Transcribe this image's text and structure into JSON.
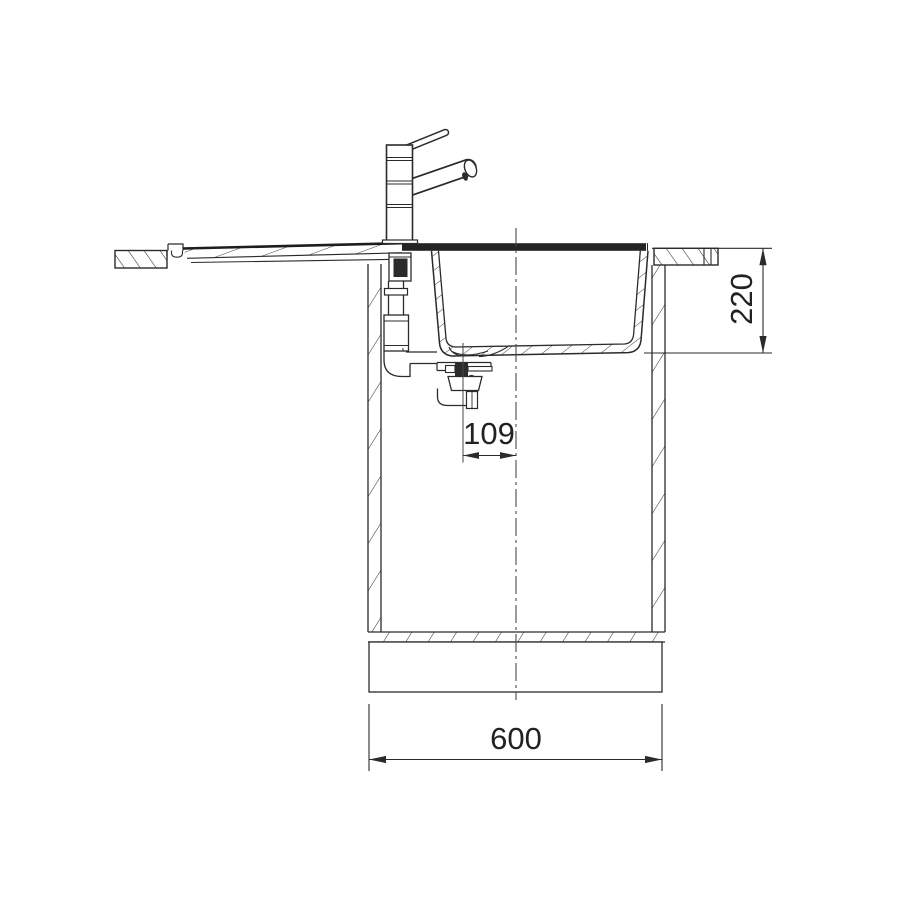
{
  "drawing": {
    "title": "Kitchen sink installation side section",
    "dimensions": {
      "bowl_depth": "220",
      "drain_to_center": "109",
      "cabinet_width": "600"
    },
    "colors": {
      "line": "#2b2b2b",
      "background": "#ffffff"
    }
  }
}
